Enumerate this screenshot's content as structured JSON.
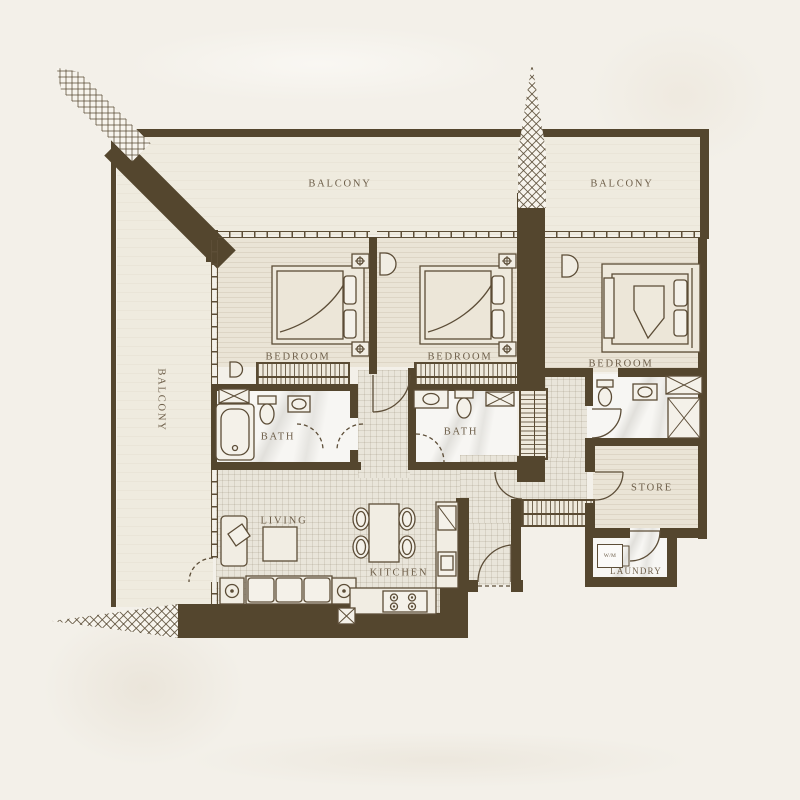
{
  "labels": {
    "balcony_top_left": "BALCONY",
    "balcony_top_right": "BALCONY",
    "balcony_side": "BALCONY",
    "bedroom_1": "BEDROOM",
    "bedroom_2": "BEDROOM",
    "bedroom_3": "BEDROOM",
    "bath_1": "BATH",
    "bath_2": "BATH",
    "living": "LIVING",
    "kitchen": "KITCHEN",
    "store": "STORE",
    "laundry": "LAUNDRY",
    "washing_machine": "W/M"
  },
  "colors": {
    "wall": "#54462e",
    "background": "#f3f0e9",
    "line": "#5c4d37",
    "label_text": "#6e5f4a"
  }
}
